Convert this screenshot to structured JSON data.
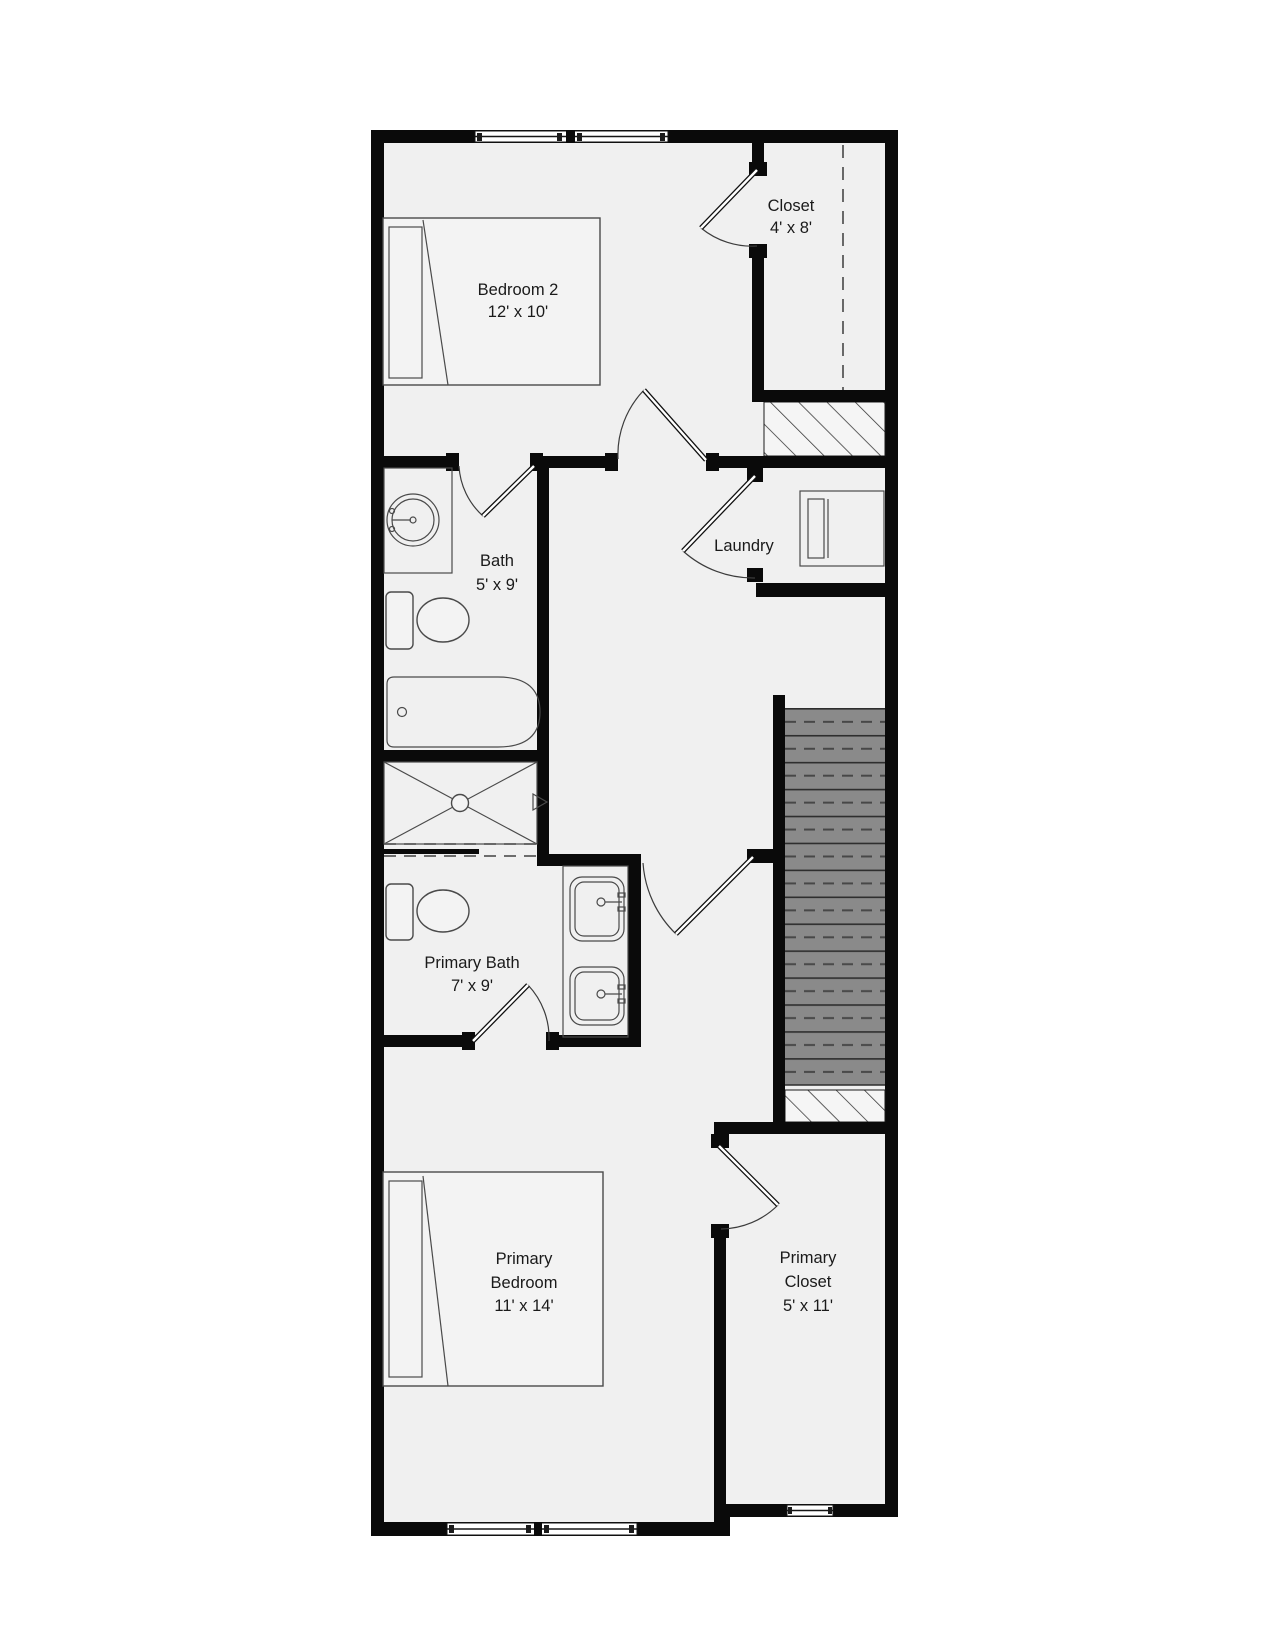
{
  "colors": {
    "wall": "#0a0a0a",
    "floor": "#f0f0f0",
    "fixture": "#f3f3f3",
    "line": "#4a4a4a",
    "text": "#1a1a1a",
    "stairs": "#8a8a8a",
    "stairline": "#2e2e2e"
  },
  "rooms": {
    "bedroom2": {
      "name": "Bedroom 2",
      "dims": "12' x 10'"
    },
    "closet": {
      "name": "Closet",
      "dims": "4' x 8'"
    },
    "bath": {
      "name": "Bath",
      "dims": "5' x 9'"
    },
    "laundry": {
      "name": "Laundry"
    },
    "primary_bath": {
      "name": "Primary Bath",
      "dims": "7' x 9'"
    },
    "primary_bedroom": {
      "line1": "Primary",
      "line2": "Bedroom",
      "dims": "11' x 14'"
    },
    "primary_closet": {
      "line1": "Primary",
      "line2": "Closet",
      "dims": "5' x 11'"
    }
  }
}
